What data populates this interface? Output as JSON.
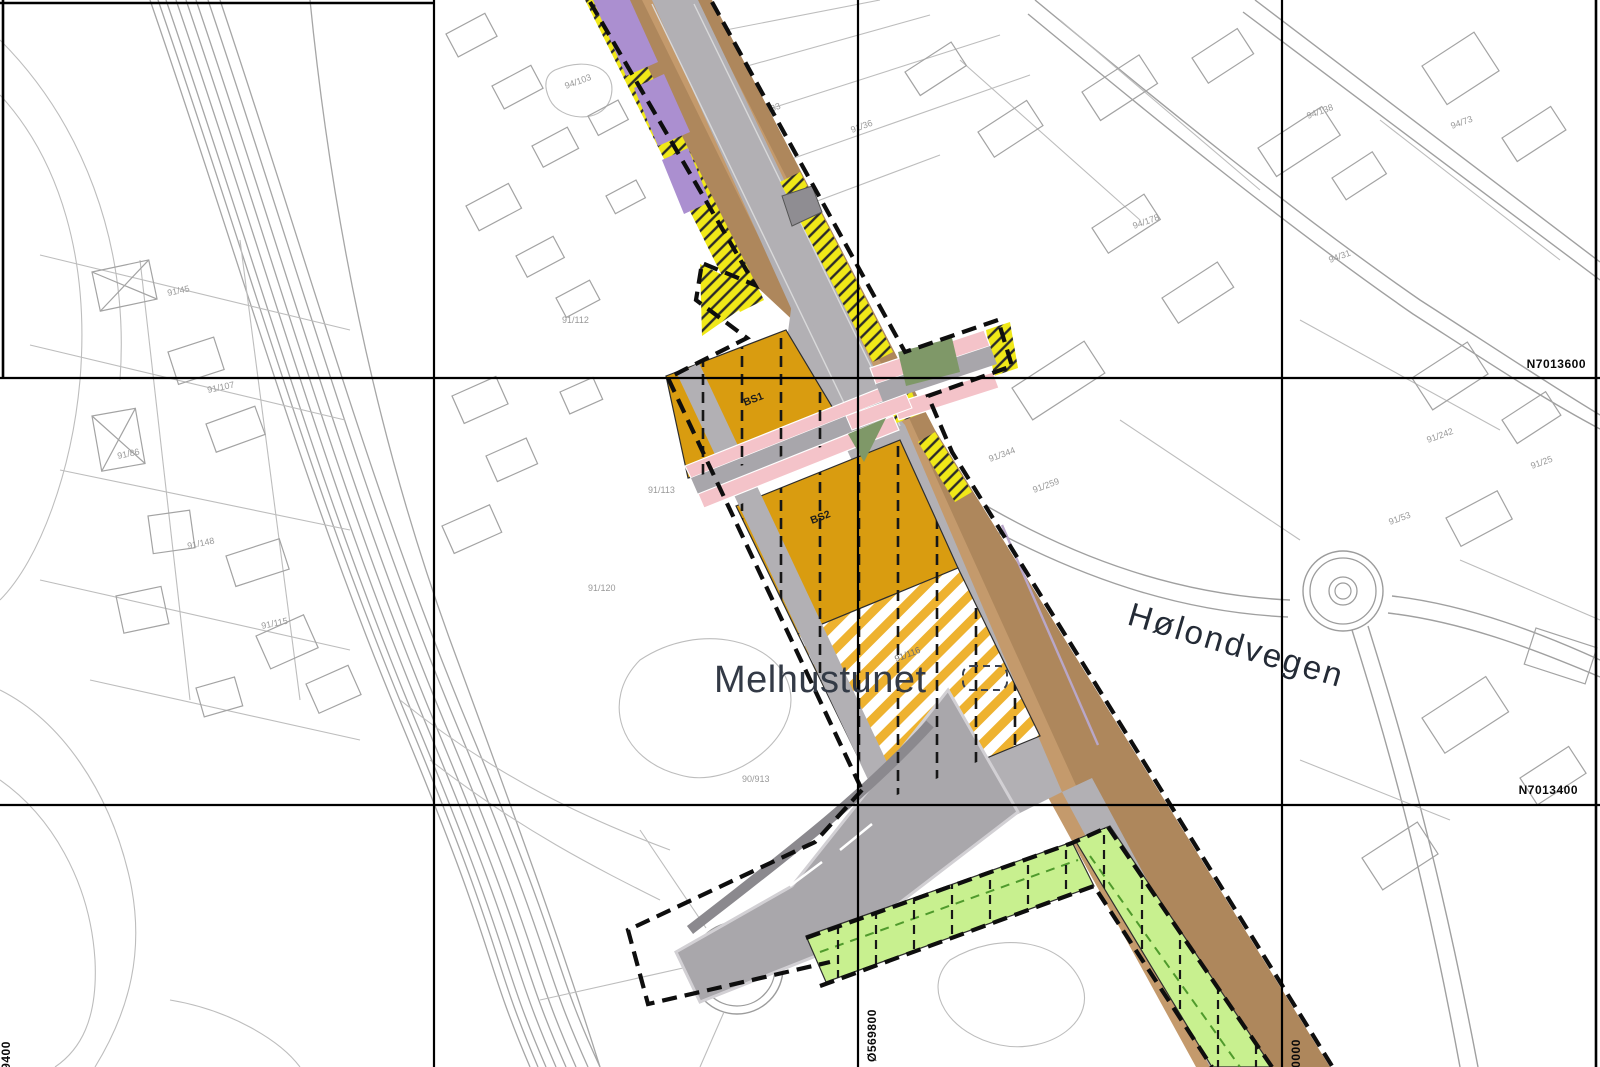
{
  "map": {
    "place_labels": {
      "area": {
        "text": "Melhustunet",
        "transform": "translate(714,692)"
      },
      "road": {
        "text": "Hølondvegen",
        "transform": "translate(1126,624) rotate(16.5)"
      }
    },
    "grid_labels": {
      "northing_upper": {
        "text": "N7013600",
        "transform": "translate(1586,368)"
      },
      "northing_lower": {
        "text": "N7013400",
        "transform": "translate(1578,794)"
      },
      "easting_mid": {
        "text": "Ø569800",
        "transform": "translate(876,1062) rotate(-90)"
      },
      "easting_right": {
        "text": "Ø570000",
        "transform": "translate(1300,1092) rotate(-90)"
      },
      "easting_left": {
        "text": "Ø569400",
        "transform": "translate(10,1094) rotate(-90)"
      }
    },
    "zone_labels": {
      "bs1": {
        "text": "BS1",
        "transform": "translate(745,406) rotate(-21)"
      },
      "bs2": {
        "text": "BS2",
        "transform": "translate(812,524) rotate(-21)"
      },
      "parcel_on_zone": {
        "text": "91/116",
        "transform": "translate(896,662) rotate(-21)"
      }
    },
    "parcel_labels": [
      {
        "text": "91/45",
        "x": 168,
        "y": 296,
        "r": -12
      },
      {
        "text": "91/107",
        "x": 208,
        "y": 393,
        "r": -12
      },
      {
        "text": "91/86",
        "x": 118,
        "y": 459,
        "r": -12
      },
      {
        "text": "91/148",
        "x": 188,
        "y": 549,
        "r": -12
      },
      {
        "text": "91/115",
        "x": 262,
        "y": 629,
        "r": -12
      },
      {
        "text": "94/103",
        "x": 566,
        "y": 89,
        "r": -20
      },
      {
        "text": "91/33",
        "x": 760,
        "y": 116,
        "r": -20
      },
      {
        "text": "91/36",
        "x": 852,
        "y": 133,
        "r": -20
      },
      {
        "text": "91/41",
        "x": 668,
        "y": 173,
        "r": -20
      },
      {
        "text": "91/112",
        "x": 562,
        "y": 323,
        "r": 0
      },
      {
        "text": "91/113",
        "x": 648,
        "y": 493,
        "r": 0
      },
      {
        "text": "91/120",
        "x": 588,
        "y": 591,
        "r": 0
      },
      {
        "text": "90/913",
        "x": 742,
        "y": 782,
        "r": 0
      },
      {
        "text": "91/344",
        "x": 990,
        "y": 462,
        "r": -20
      },
      {
        "text": "91/259",
        "x": 1034,
        "y": 493,
        "r": -20
      },
      {
        "text": "94/178",
        "x": 1134,
        "y": 229,
        "r": -20
      },
      {
        "text": "94/138",
        "x": 1308,
        "y": 119,
        "r": -20
      },
      {
        "text": "94/73",
        "x": 1452,
        "y": 129,
        "r": -20
      },
      {
        "text": "94/31",
        "x": 1330,
        "y": 263,
        "r": -20
      },
      {
        "text": "91/242",
        "x": 1428,
        "y": 443,
        "r": -20
      },
      {
        "text": "91/25",
        "x": 1532,
        "y": 469,
        "r": -20
      },
      {
        "text": "91/53",
        "x": 1390,
        "y": 525,
        "r": -20
      }
    ],
    "colors": {
      "corridor_brown": "#ae875c",
      "corridor_tan": "#c49a6c",
      "road_gray": "#b2b0b4",
      "road_gray_dark": "#8f8d92",
      "center_orange": "#d99c10",
      "stripe_yellow": "#eeb22f",
      "edge_yellow": "#f0e818",
      "green_zone": "#c8f08f",
      "sidewalk_pink": "#f4c3c9",
      "purple_zone": "#ab8fd0",
      "olive_green": "#7f9868",
      "grid_black": "#000000",
      "basemap_gray": "#a6a6a6"
    }
  }
}
